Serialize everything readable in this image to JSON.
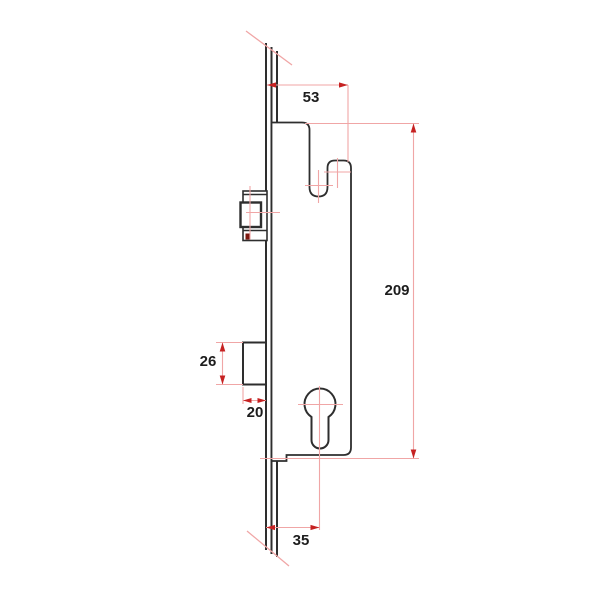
{
  "dimensions": {
    "hook_offset": "53",
    "case_height": "209",
    "deadbolt_height": "26",
    "deadbolt_throw": "20",
    "backset": "35"
  },
  "colors": {
    "outline": "#2e2e2e",
    "background": "#ffffff",
    "dimension_line": "#f0a6a6",
    "centerline": "#f0a6a6",
    "arrow": "#c62222",
    "marker_fill": "#7d170e",
    "text": "#1d1d1d"
  }
}
